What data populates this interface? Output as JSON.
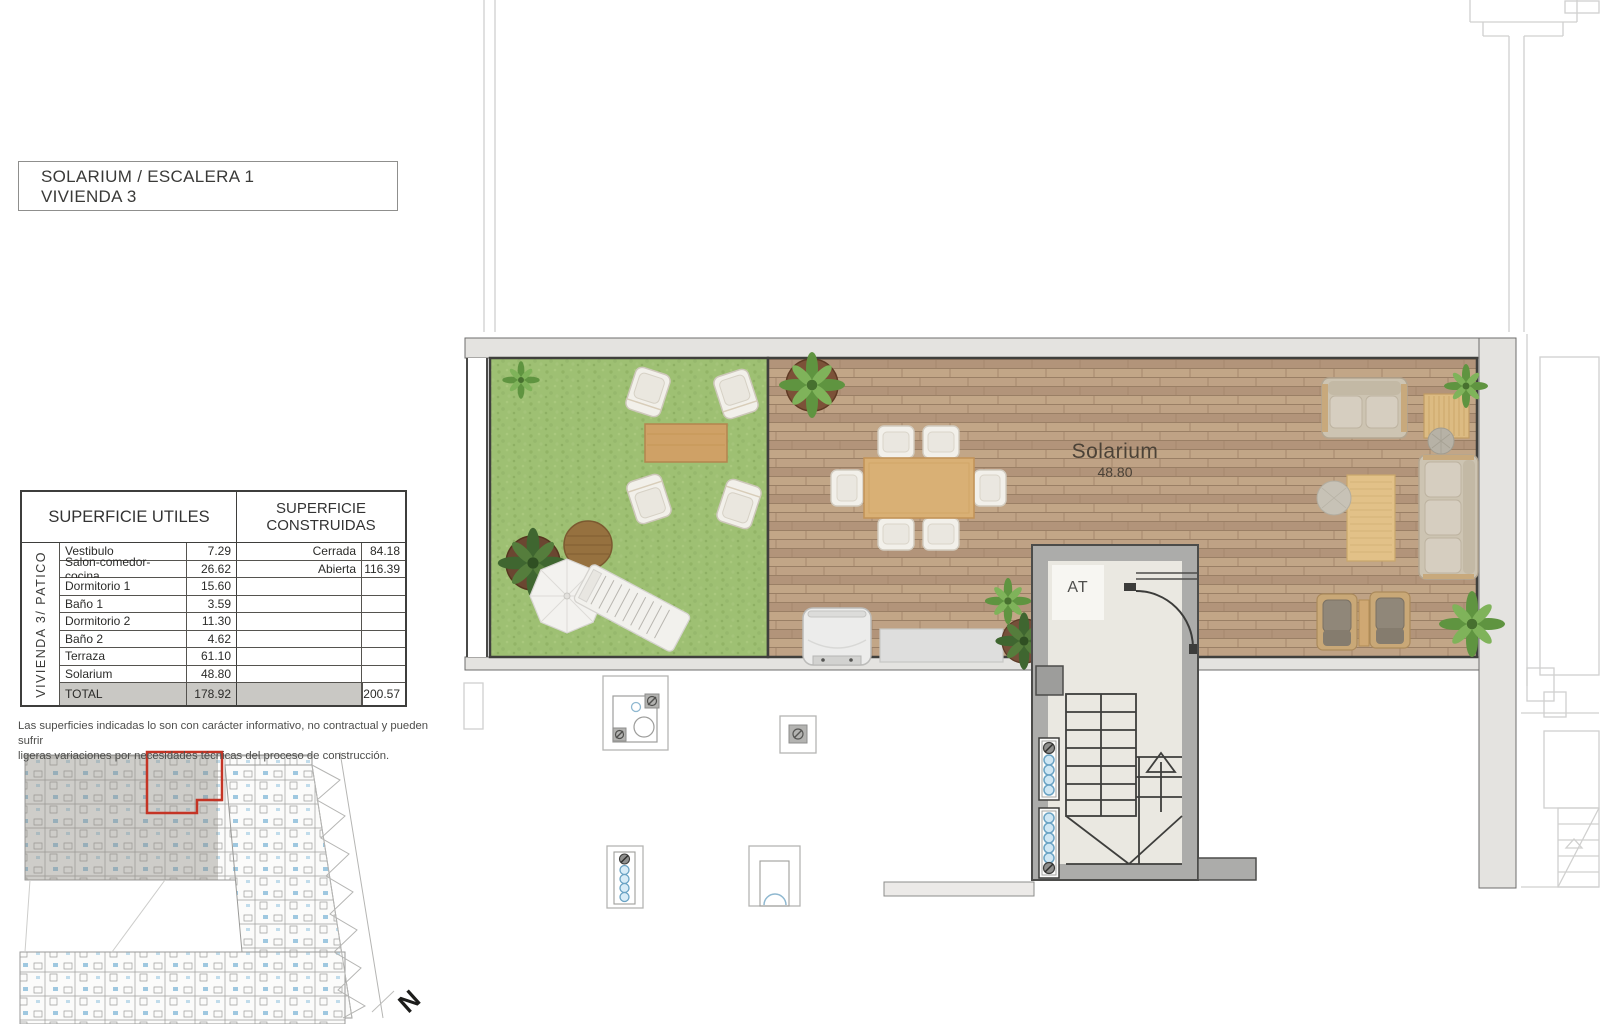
{
  "title_block": {
    "line1": "SOLARIUM / ESCALERA 1",
    "line2": "VIVIENDA 3"
  },
  "areas_table": {
    "header_left": "SUPERFICIE UTILES",
    "header_right_line1": "SUPERFICIE",
    "header_right_line2": "CONSTRUIDAS",
    "side_label": "VIVIENDA  3/ PATICO",
    "rows": [
      {
        "name": "Vestibulo",
        "value": "7.29",
        "built_label": "Cerrada",
        "built_value": "84.18"
      },
      {
        "name": "Salon-comedor-cocina",
        "value": "26.62",
        "built_label": "Abierta",
        "built_value": "116.39"
      },
      {
        "name": "Dormitorio 1",
        "value": "15.60",
        "built_label": "",
        "built_value": ""
      },
      {
        "name": "Baño 1",
        "value": "3.59",
        "built_label": "",
        "built_value": ""
      },
      {
        "name": "Dormitorio 2",
        "value": "11.30",
        "built_label": "",
        "built_value": ""
      },
      {
        "name": "Baño 2",
        "value": "4.62",
        "built_label": "",
        "built_value": ""
      },
      {
        "name": "Terraza",
        "value": "61.10",
        "built_label": "",
        "built_value": ""
      },
      {
        "name": "Solarium",
        "value": "48.80",
        "built_label": "",
        "built_value": ""
      }
    ],
    "total_row": {
      "name": "TOTAL",
      "value": "178.92",
      "built_label": "",
      "built_value": "200.57"
    }
  },
  "disclaimer": {
    "line1": "Las superficies indicadas lo son con carácter informativo, no contractual y pueden sufrir",
    "line2": "ligeras variaciones por necesidades técnicas del proceso de construcción."
  },
  "plan_labels": {
    "room_name": "Solarium",
    "room_area": "48.80",
    "stairwell_tag": "AT"
  },
  "key_plan": {
    "north_label": "N"
  },
  "colors": {
    "highlight_red": "#c43425",
    "grass_green": "#9ec073",
    "deck_wood": "#b89b7e",
    "wall_gray": "#e4e3e0",
    "total_row_gray": "#c9c8c4"
  }
}
